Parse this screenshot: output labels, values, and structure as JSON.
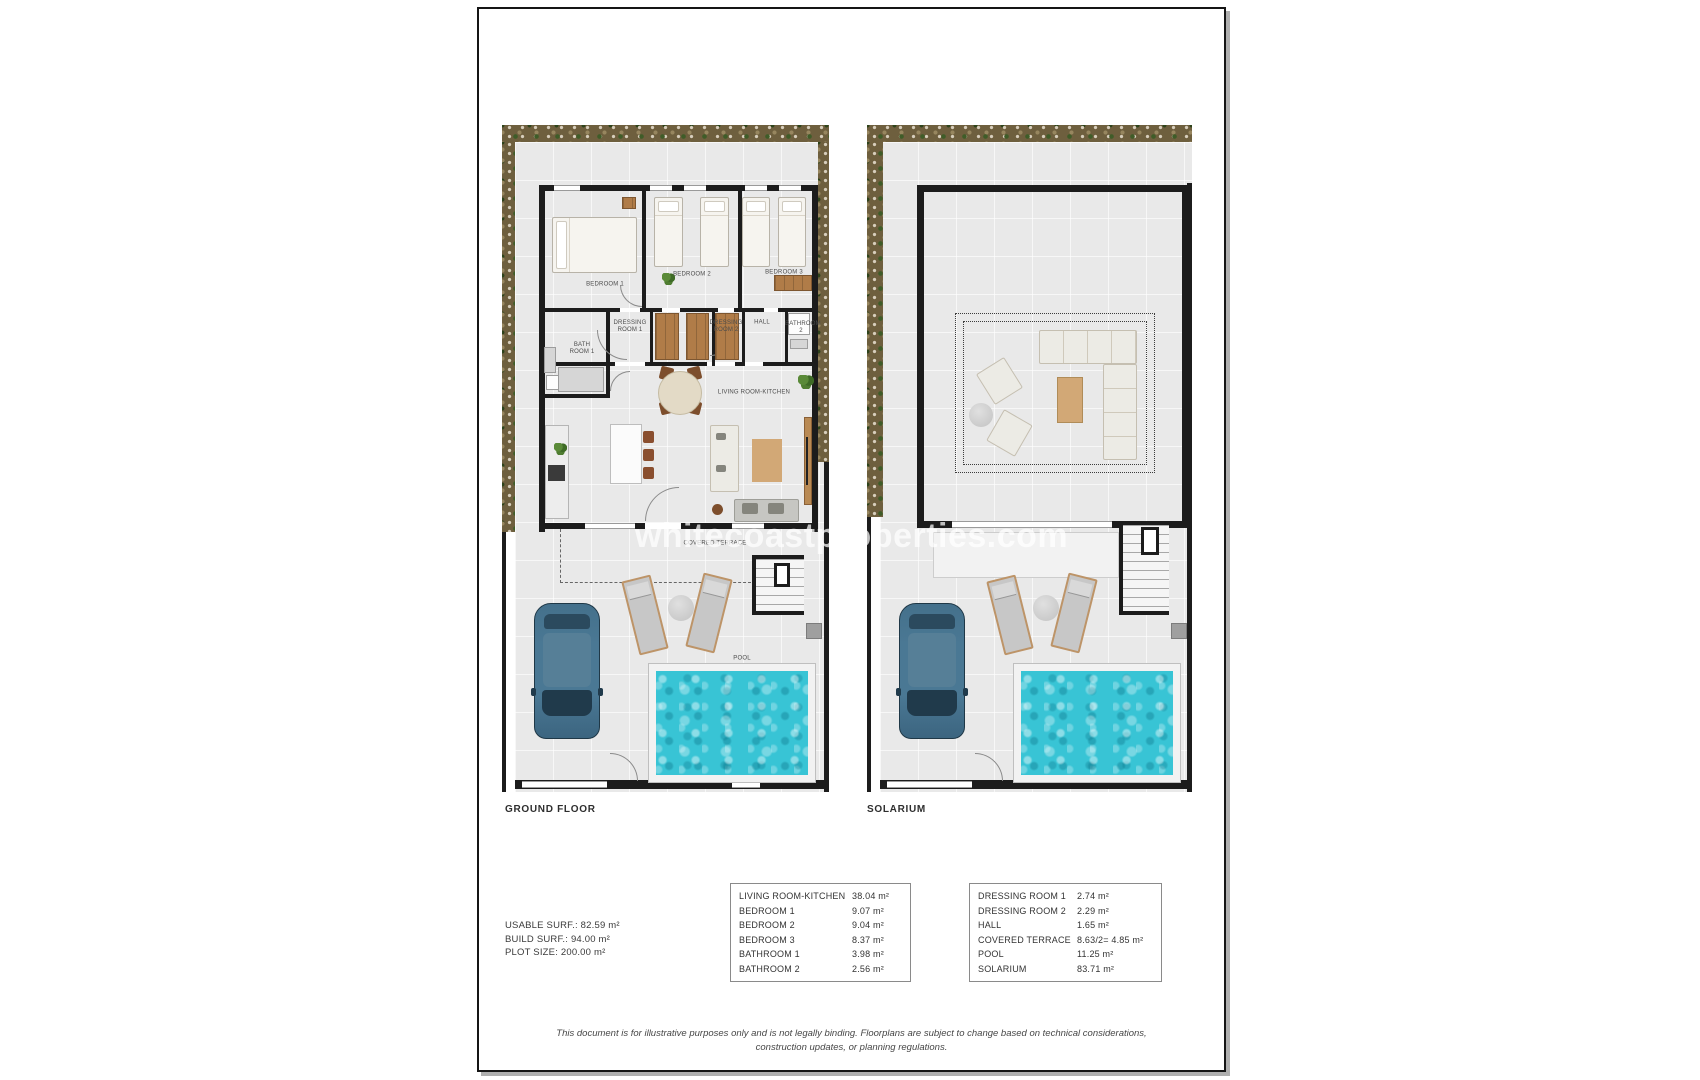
{
  "watermark": "whitecoastproperties.com",
  "plans": {
    "ground": {
      "title": "GROUND FLOOR",
      "rooms": {
        "bedroom1": "BEDROOM 1",
        "bedroom2": "BEDROOM 2",
        "bedroom3": "BEDROOM 3",
        "bath1": "BATH ROOM 1",
        "dress1": "DRESSING ROOM 1",
        "dress2": "DRESSING ROOM 2",
        "hall": "HALL",
        "bath2": "BATHROOM 2",
        "living": "LIVING ROOM-KITCHEN",
        "terrace": "COVERED TERRACE",
        "pool": "POOL"
      }
    },
    "solarium": {
      "title": "SOLARIUM"
    }
  },
  "summary": {
    "usable": "USABLE SURF.: 82.59 m²",
    "build": "BUILD SURF.: 94.00 m²",
    "plot": "PLOT SIZE: 200.00 m²"
  },
  "table1": {
    "rows": [
      {
        "label": "LIVING ROOM-KITCHEN",
        "value": "38.04 m²"
      },
      {
        "label": "BEDROOM 1",
        "value": "9.07 m²"
      },
      {
        "label": "BEDROOM 2",
        "value": "9.04 m²"
      },
      {
        "label": "BEDROOM 3",
        "value": "8.37 m²"
      },
      {
        "label": "BATHROOM 1",
        "value": "3.98 m²"
      },
      {
        "label": "BATHROOM 2",
        "value": "2.56 m²"
      }
    ]
  },
  "table2": {
    "rows": [
      {
        "label": "DRESSING ROOM 1",
        "value": "2.74 m²"
      },
      {
        "label": "DRESSING ROOM 2",
        "value": "2.29 m²"
      },
      {
        "label": "HALL",
        "value": "1.65 m²"
      },
      {
        "label": "COVERED TERRACE",
        "value": "8.63/2= 4.85 m²"
      },
      {
        "label": "POOL",
        "value": "11.25 m²"
      },
      {
        "label": "SOLARIUM",
        "value": "83.71 m²"
      }
    ]
  },
  "disclaimer": {
    "line1": "This document is for illustrative purposes only and is not legally binding. Floorplans are subject to change based on technical considerations,",
    "line2": "construction updates, or planning regulations."
  },
  "colors": {
    "pool": "#38c4d5",
    "wall": "#1c1c1c",
    "garden": "#6e5f3e",
    "car": "#4a7894",
    "wood": "#d2a876"
  }
}
